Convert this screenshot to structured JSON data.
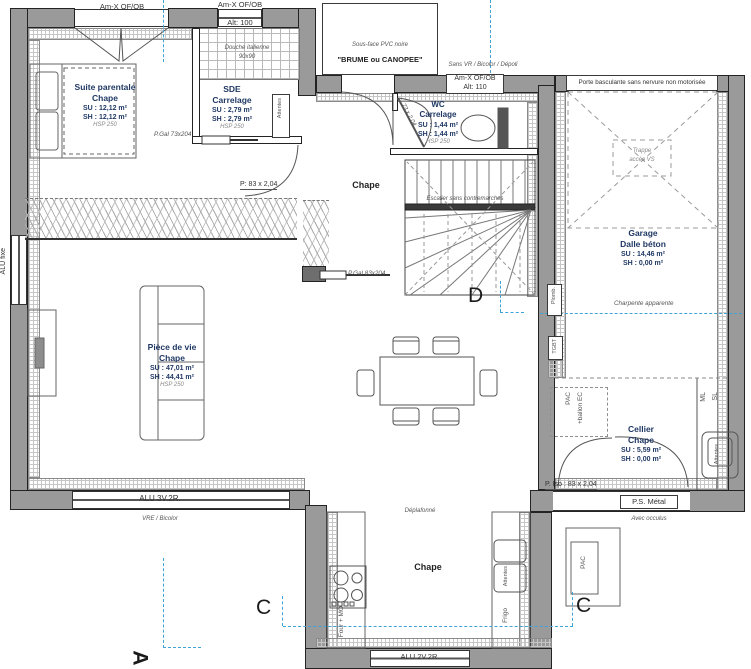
{
  "colors": {
    "wall": "#9a9a9a",
    "axis_blue": "#3fa3d8",
    "stat_text": "#1f3864",
    "line": "#333333"
  },
  "windows": {
    "am_x_1": "Am-X OF/OB",
    "am_x_2_l1": "Am-X OF/OB",
    "am_x_2_l2": "Alt: 100",
    "am_x_3_l1": "Am-X OF/OB",
    "am_x_3_l2": "Alt: 110",
    "sans_vr": "Sans VR / Bicolor / Dépoli",
    "garage_door": "Porte basculante sans nervure non motorisée",
    "alu_fixe": "ALU fixe",
    "alu_3v": "ALU 3V.2R.",
    "vre": "VRE / Bicolor",
    "alu_2v": "ALU 2V.2R.",
    "ps_metal": "P.S. Métal",
    "avec_occulus": "Avec occulus",
    "p_iso": "P. Iso : 83 x 2,04"
  },
  "porch": {
    "note": "Sous-face PVC noire",
    "name": "\"BRUME ou CANOPEE\""
  },
  "rooms": {
    "suite": {
      "name": "Suite parentale",
      "floor": "Chape",
      "su": "SU : 12,12 m²",
      "sh": "SH : 12,12 m²",
      "hsp": "HSP 250"
    },
    "sde": {
      "name": "SDE",
      "floor": "Carrelage",
      "su": "SU : 2,79 m²",
      "sh": "SH : 2,79 m²",
      "hsp": "HSP 250"
    },
    "wc": {
      "name": "WC",
      "floor": "Carrelage",
      "su": "SU : 1,44 m²",
      "sh": "SH : 1,44 m²",
      "hsp": "HSP 250"
    },
    "garage": {
      "name": "Garage",
      "floor": "Dalle béton",
      "su": "SU : 14,46 m²",
      "sh": "SH : 0,00 m²"
    },
    "vie": {
      "name": "Pièce de vie",
      "floor": "Chape",
      "su": "SU : 47,01 m²",
      "sh": "SH : 44,41 m²",
      "hsp": "HSP 250"
    },
    "cellier": {
      "name": "Cellier",
      "floor": "Chape",
      "su": "SU : 5,59 m²",
      "sh": "SH : 0,00 m²"
    },
    "hall_floor": "Chape",
    "kitchen_floor": "Chape"
  },
  "doors": {
    "p_gal_73": "P.Gal 73x204",
    "p_83": "P: 83 x 2,04",
    "p_gal_83": "P.Gal 83x204",
    "wc_door": "73 x 2,04"
  },
  "annotations": {
    "douche_l1": "Douche italienne",
    "douche_l2": "90x90",
    "escalier": "Escalier sans contremarches",
    "trappe_l1": "Trappe",
    "trappe_l2": "accès VS",
    "charpente": "Charpente apparente",
    "deplafonne": "Déplafonné",
    "plomb": "Plomb.",
    "tgbt": "TGBT",
    "pac_ballon_l1": "PAC",
    "pac_ballon_l2": "+ballon EC",
    "ml": "ML",
    "sl": "SL",
    "attentes": "Attentes",
    "four_mo": "Four + MO",
    "frigo": "Frigo",
    "pac": "PAC"
  },
  "markers": {
    "c": "C",
    "d": "D",
    "a": "A"
  }
}
